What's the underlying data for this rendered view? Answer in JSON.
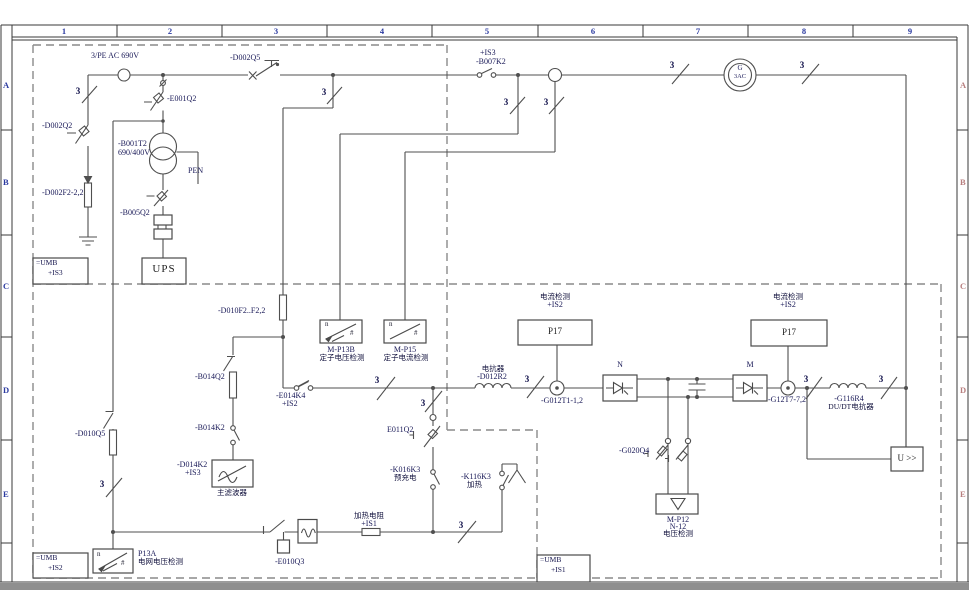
{
  "title": "converter single-line electrical schematic",
  "grid": {
    "columns": [
      "1",
      "2",
      "3",
      "4",
      "5",
      "6",
      "7",
      "8",
      "9"
    ],
    "rows": [
      "A",
      "B",
      "C",
      "D",
      "E"
    ]
  },
  "labels": {
    "pe_ac": "3/PE AC 690V",
    "d002q5": "-D002Q5",
    "is3_top": "+IS3",
    "b007k2": "-B007K2",
    "e001q2": "-E001Q2",
    "d002q2": "-D002Q2",
    "b001t2": "-B001T2",
    "b001t2_v": "690/400V",
    "pen": "PEN",
    "d002f2": "-D002F2-2,2",
    "b005q2": "-B005Q2",
    "ups": "UPS",
    "gen_g": "G",
    "gen_3ac": "3AC",
    "d010f2": "-D010F2..F2,2",
    "mp13b": "M-P13B",
    "mp13b_cn": "定子电压检测",
    "mp15": "M-P15",
    "mp15_cn": "定子电流检测",
    "b014q2": "-B014Q2",
    "b014k2": "-B014K2",
    "d014k2": "-D014K2",
    "d014k2_loc": "+IS3",
    "filter_cn": "主滤波器",
    "e014k4": "-E014K4",
    "is2": "+IS2",
    "d010q5": "-D010Q5",
    "curr_cn": "电流检测",
    "p17": "P17",
    "reactor_cn": "电抗器",
    "d012r2": "-D012R2",
    "g012t1": "-G012T1-1,2",
    "n": "N",
    "m": "M",
    "g12t7": "-G12T7-7,2",
    "g116r4": "-G116R4",
    "dudt_cn": "DU/DT电抗器",
    "g020q4": "-G020Q4",
    "mp12": "M-P12",
    "n12": "N-12",
    "volt_cn": "电压检测",
    "u_box": "U >>",
    "e011q2": "E011Q2",
    "k016k3": "-K016K3",
    "precharge_cn": "预充电",
    "k116k3": "-K116K3",
    "heat_cn": "加热",
    "heat_res_cn": "加热电阻",
    "heat_res_loc": "+IS1",
    "e010q3": "-E010Q3",
    "p13a": "P13A",
    "grid_volt_cn": "电网电压检测",
    "umb": "=UMB",
    "is3": "+IS3",
    "is1": "+IS1",
    "three": "3",
    "meas_n": "n",
    "meas_hash": "#"
  }
}
